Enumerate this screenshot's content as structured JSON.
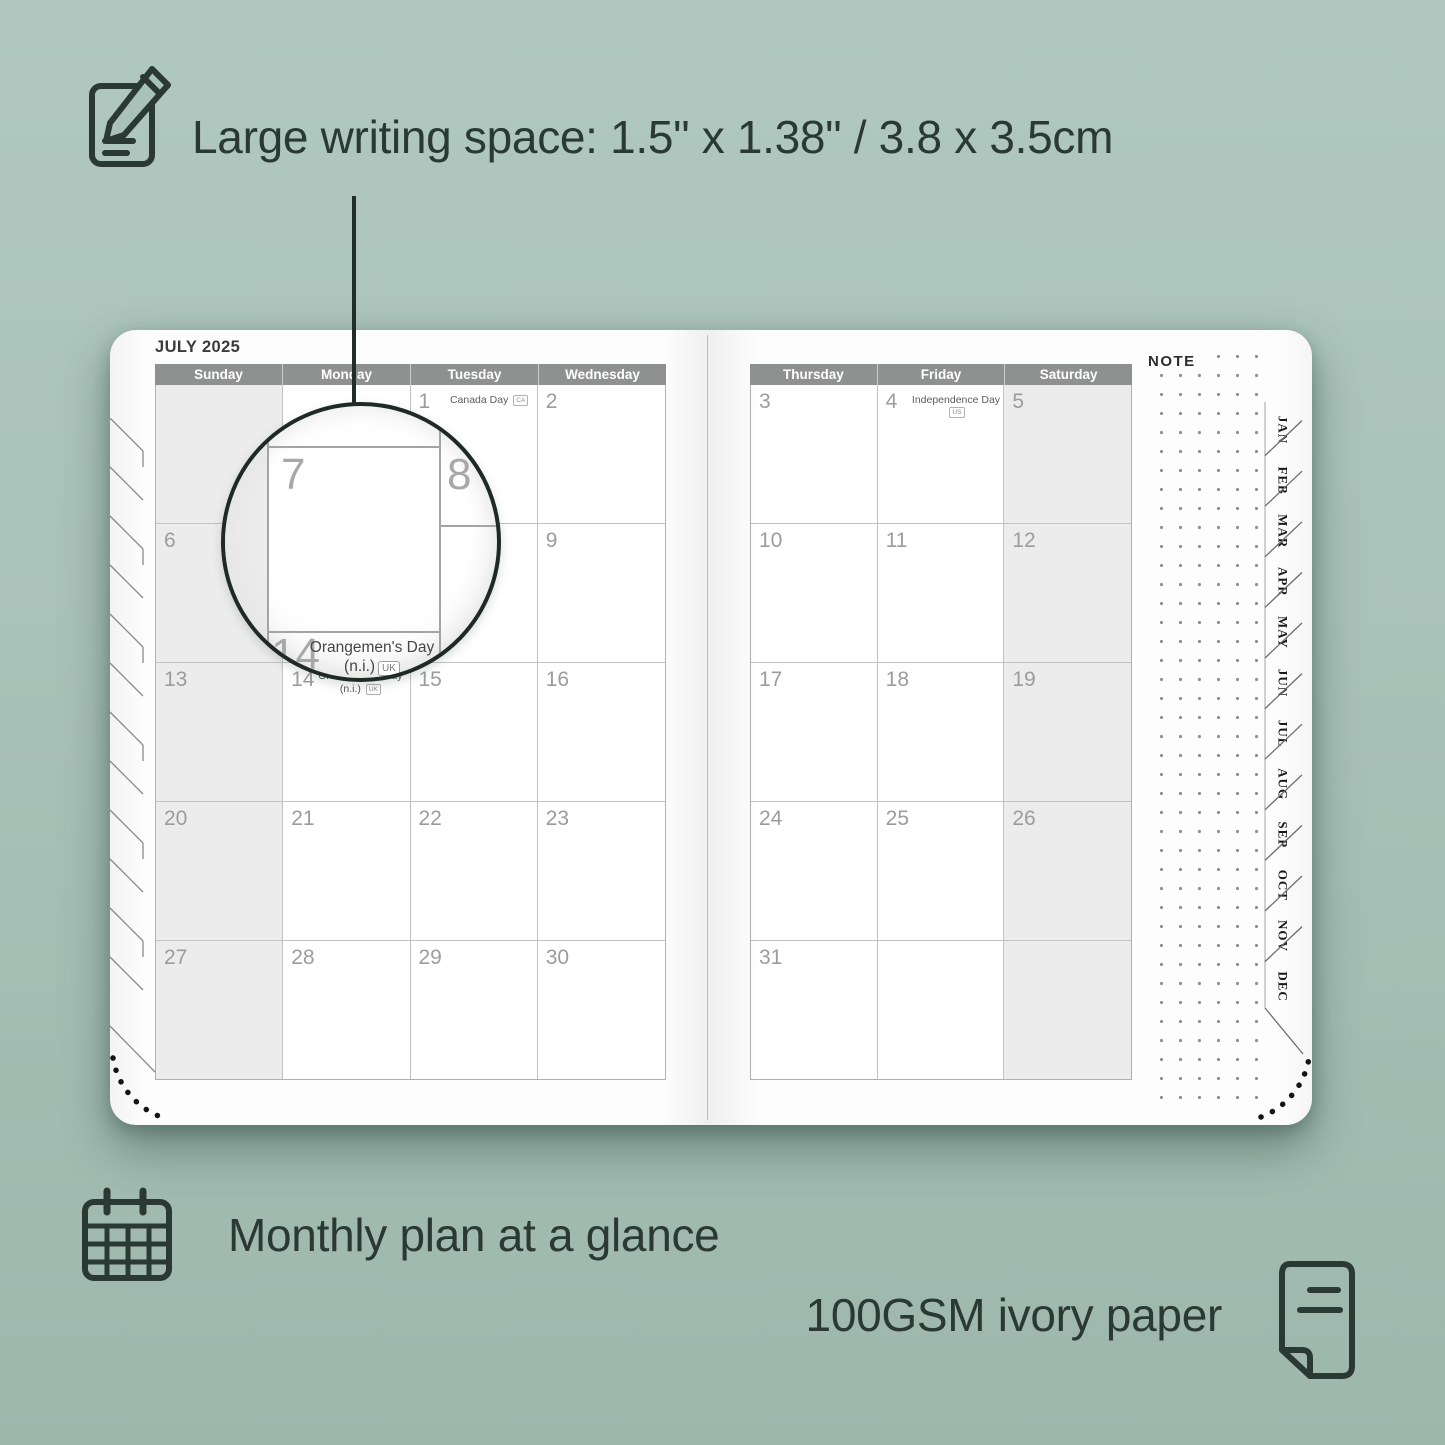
{
  "colors": {
    "background": "#a9c2b9",
    "accent_text": "#2b3935",
    "day_header_bar": "#8f9090",
    "weekend_fill": "#ececec",
    "date_number": "#9c9c9c"
  },
  "features": {
    "writing": {
      "label": "Large writing space: 1.5\" x 1.38\" / 3.8 x 3.5cm"
    },
    "monthly": {
      "label": "Monthly plan at a glance"
    },
    "paper": {
      "label": "100GSM ivory paper"
    }
  },
  "calendar": {
    "title": "JULY 2025",
    "note_label": "NOTE",
    "left_page": {
      "day_headers": [
        "Sunday",
        "Monday",
        "Tuesday",
        "Wednesday"
      ],
      "weekend_columns": [
        0
      ],
      "rows": [
        [
          {
            "date": ""
          },
          {
            "date": ""
          },
          {
            "date": "1",
            "holiday": "Canada Day",
            "badge": "CA"
          },
          {
            "date": "2"
          }
        ],
        [
          {
            "date": "6"
          },
          {
            "date": "7"
          },
          {
            "date": "8"
          },
          {
            "date": "9"
          }
        ],
        [
          {
            "date": "13"
          },
          {
            "date": "14",
            "holiday_lines": [
              "Orangemen's Day",
              "(n.i.)"
            ],
            "badge": "UK"
          },
          {
            "date": "15"
          },
          {
            "date": "16"
          }
        ],
        [
          {
            "date": "20"
          },
          {
            "date": "21"
          },
          {
            "date": "22"
          },
          {
            "date": "23"
          }
        ],
        [
          {
            "date": "27"
          },
          {
            "date": "28"
          },
          {
            "date": "29"
          },
          {
            "date": "30"
          }
        ]
      ]
    },
    "right_page": {
      "day_headers": [
        "Thursday",
        "Friday",
        "Saturday"
      ],
      "weekend_columns": [
        2
      ],
      "rows": [
        [
          {
            "date": "3"
          },
          {
            "date": "4",
            "holiday": "Independence Day",
            "badge": "US"
          },
          {
            "date": "5"
          }
        ],
        [
          {
            "date": "10"
          },
          {
            "date": "11"
          },
          {
            "date": "12"
          }
        ],
        [
          {
            "date": "17"
          },
          {
            "date": "18"
          },
          {
            "date": "19"
          }
        ],
        [
          {
            "date": "24"
          },
          {
            "date": "25"
          },
          {
            "date": "26"
          }
        ],
        [
          {
            "date": "31"
          },
          {
            "date": ""
          },
          {
            "date": ""
          }
        ]
      ]
    },
    "month_tabs": [
      "JAN",
      "FEB",
      "MAR",
      "APR",
      "MAY",
      "JUN",
      "JUL",
      "AUG",
      "SEP",
      "OCT",
      "NOV",
      "DEC"
    ],
    "magnifier": {
      "cell_date": "7",
      "next_date": "8",
      "below_date": "14",
      "holiday_line1": "Orangemen's Day",
      "holiday_line2": "(n.i.)",
      "badge": "UK"
    }
  }
}
